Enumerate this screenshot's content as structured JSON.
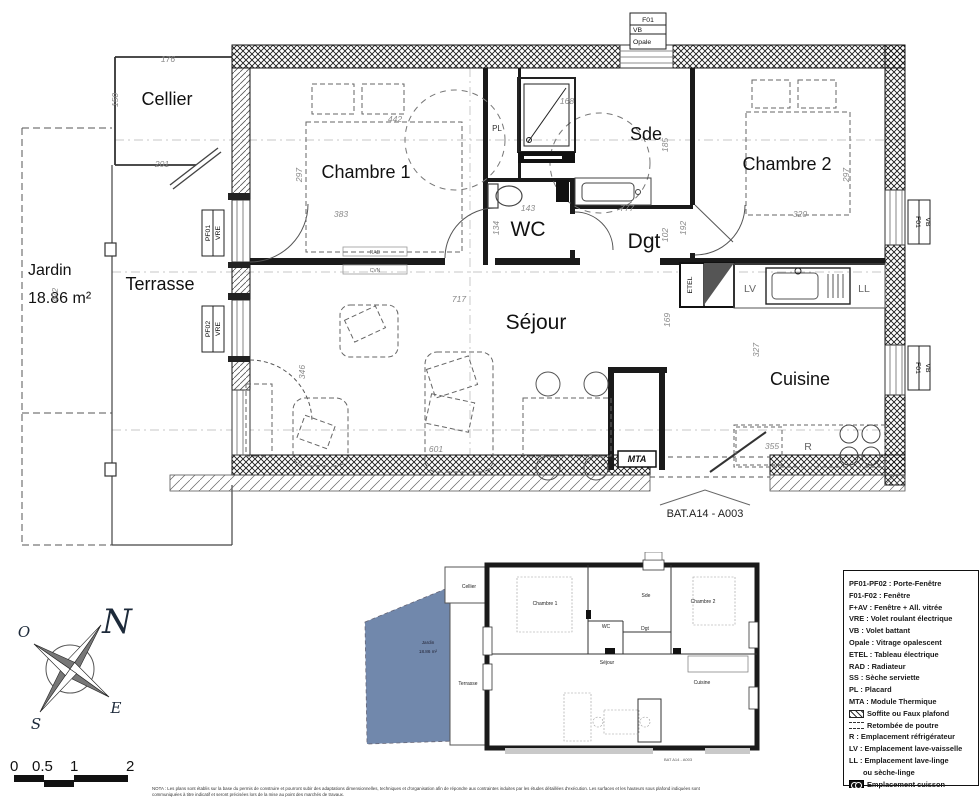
{
  "plan": {
    "rooms": {
      "cellier": "Cellier",
      "chambre1": "Chambre 1",
      "sde": "Sde",
      "chambre2": "Chambre 2",
      "wc": "WC",
      "dgt": "Dgt",
      "sejour": "Séjour",
      "cuisine": "Cuisine",
      "terrasse": "Terrasse",
      "jardin": "Jardin",
      "jardin_area": "18.86 m²"
    },
    "dims": {
      "cellier_w": "176",
      "cellier_h": "150",
      "cellier_b": "201",
      "terrasse_h": "472",
      "ch1_h": "297",
      "ch1_w": "442",
      "ch1_b": "383",
      "wc_w": "143",
      "wc_h": "134",
      "dgt_w": "777",
      "dgt_h": "102",
      "dgt_h2": "192",
      "sde_w": "168",
      "sde_h": "185",
      "ch2_w": "320",
      "ch2_h": "297",
      "sejour_w": "717",
      "sejour_h": "346",
      "sejour_b": "601",
      "cuisine_h": "169",
      "cuisine_h2": "327",
      "cuisine_b": "355"
    },
    "tags": {
      "window_top": [
        "F01",
        "VB",
        "Opale"
      ],
      "pf01": [
        "PF01",
        "VRE"
      ],
      "pf02": [
        "PF02",
        "VRE"
      ],
      "f01": [
        "F01",
        "VB"
      ],
      "etel": "ETEL",
      "mta": "MTA",
      "rad": "RAD",
      "cvn": "CVN",
      "pl": "PL",
      "lv": "LV",
      "ll": "LL",
      "r": "R"
    },
    "bat_label": "BAT.A14 - A003"
  },
  "mini": {
    "labels": {
      "cellier": "Cellier",
      "chambre1": "Chambre 1",
      "sde": "Sde",
      "chambre2": "Chambre 2",
      "wc": "WC",
      "dgt": "Dgt",
      "sejour": "Séjour",
      "cuisine": "Cuisine",
      "terrasse": "Terrasse",
      "jardin": "Jardin",
      "jardin_area": "18.86 m²",
      "bat": "BAT A14 - A003"
    },
    "jardin_color": "#7188ac"
  },
  "legend": {
    "items": [
      {
        "text": "PF01-PF02 : Porte-Fenêtre"
      },
      {
        "text": "F01-F02 : Fenêtre"
      },
      {
        "text": "F+AV : Fenêtre + All. vitrée"
      },
      {
        "text": "VRE : Volet roulant électrique"
      },
      {
        "text": "VB : Volet battant"
      },
      {
        "text": "Opale : Vitrage opalescent"
      },
      {
        "text": "ETEL : Tableau électrique"
      },
      {
        "text": "RAD : Radiateur"
      },
      {
        "text": "SS : Sèche serviette"
      },
      {
        "text": "PL : Placard"
      },
      {
        "text": "MTA : Module Thermique"
      },
      {
        "text": "Soffite ou Faux plafond"
      },
      {
        "text": "Retombée de poutre"
      },
      {
        "text": "R : Emplacement réfrigérateur"
      },
      {
        "text": "LV : Emplacement lave-vaisselle"
      },
      {
        "text": "LL : Emplacement lave-linge",
        "text2": "ou sèche-linge"
      },
      {
        "text": "Emplacement cuisson"
      }
    ]
  },
  "compass": {
    "n": "N",
    "e": "E",
    "s": "S",
    "o": "O"
  },
  "scale": {
    "labels": [
      "0",
      "0.5",
      "1",
      "2"
    ]
  },
  "nota": {
    "line1": "NOTA : Les plans sont établis sur la base du permis de construire et pourront subir des adaptations dimensionnelles, techniques et d'organisation afin de répondre aux contraintes induites par les études détaillées d'exécution. Les surfaces et les hauteurs sous plafond indiquées sont",
    "line2": "communiquées à titre indicatif et seront précisées lors de la mise au point des marchés de travaux."
  }
}
